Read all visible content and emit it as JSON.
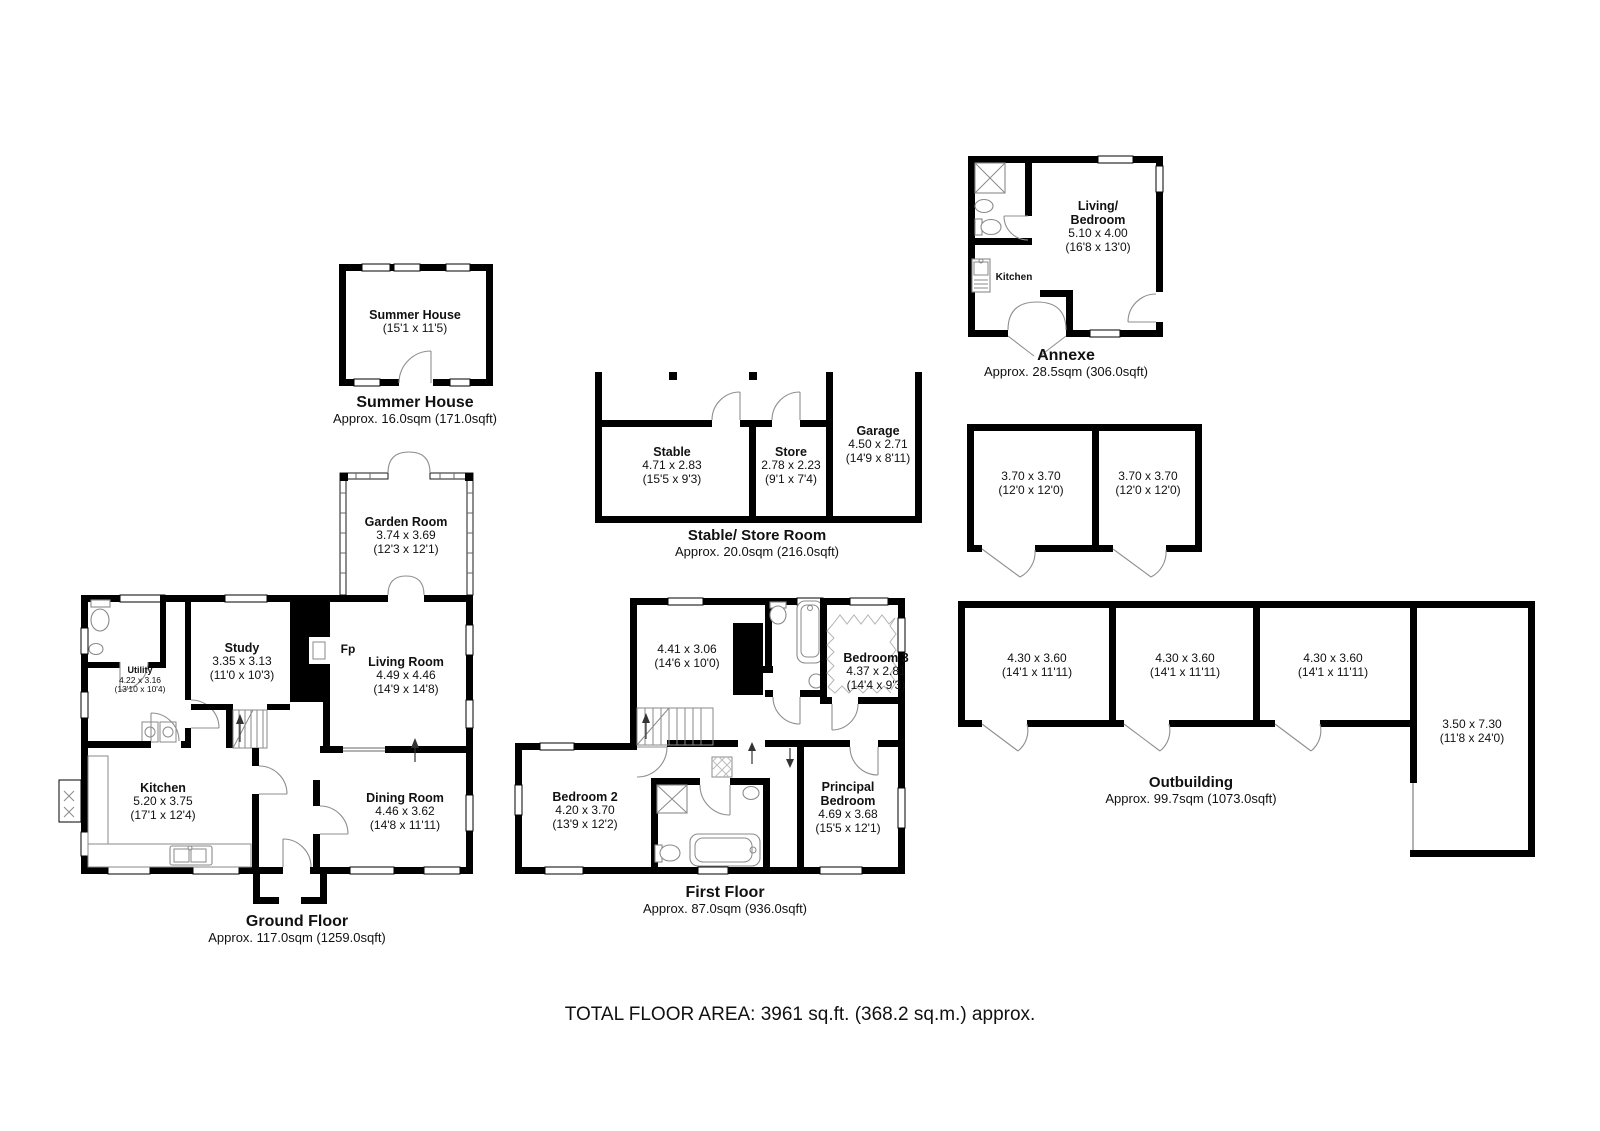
{
  "total_line": "TOTAL FLOOR AREA: 3961 sq.ft. (368.2 sq.m.) approx.",
  "summer_house": {
    "room": {
      "name": "Summer House",
      "ft": "(15'1 x 11'5)"
    },
    "title": "Summer House",
    "area": "Approx. 16.0sqm (171.0sqft)"
  },
  "garden_room": {
    "name": "Garden Room",
    "m": "3.74 x 3.69",
    "ft": "(12'3 x 12'1)"
  },
  "ground_floor": {
    "title": "Ground Floor",
    "area": "Approx. 117.0sqm (1259.0sqft)",
    "utility": {
      "name": "Utility",
      "m": "4.22 x 3.16",
      "ft": "(13'10 x 10'4)"
    },
    "study": {
      "name": "Study",
      "m": "3.35 x 3.13",
      "ft": "(11'0 x 10'3)"
    },
    "living": {
      "name": "Living Room",
      "m": "4.49 x 4.46",
      "ft": "(14'9 x 14'8)"
    },
    "kitchen": {
      "name": "Kitchen",
      "m": "5.20 x 3.75",
      "ft": "(17'1 x 12'4)"
    },
    "dining": {
      "name": "Dining Room",
      "m": "4.46 x 3.62",
      "ft": "(14'8 x 11'11)"
    },
    "fireplace": "Fp"
  },
  "stable_block": {
    "title": "Stable/ Store Room",
    "area": "Approx. 20.0sqm (216.0sqft)",
    "stable": {
      "name": "Stable",
      "m": "4.71 x 2.83",
      "ft": "(15'5 x 9'3)"
    },
    "store": {
      "name": "Store",
      "m": "2.78 x 2.23",
      "ft": "(9'1 x 7'4)"
    },
    "garage": {
      "name": "Garage",
      "m": "4.50 x 2.71",
      "ft": "(14'9 x 8'11)"
    }
  },
  "annexe": {
    "title": "Annexe",
    "area": "Approx. 28.5sqm (306.0sqft)",
    "living": {
      "name1": "Living/",
      "name2": "Bedroom",
      "m": "5.10 x 4.00",
      "ft": "(16'8 x 13'0)"
    },
    "kitchen_label": "Kitchen"
  },
  "garden_stores": {
    "room1": {
      "m": "3.70 x 3.70",
      "ft": "(12'0 x 12'0)"
    },
    "room2": {
      "m": "3.70 x 3.70",
      "ft": "(12'0 x 12'0)"
    }
  },
  "first_floor": {
    "title": "First Floor",
    "area": "Approx. 87.0sqm (936.0sqft)",
    "landing": {
      "m": "4.41 x 3.06",
      "ft": "(14'6 x 10'0)"
    },
    "bedroom3": {
      "name": "Bedroom 3",
      "m": "4.37 x 2.81",
      "ft": "(14'4 x 9'3)"
    },
    "bedroom2": {
      "name": "Bedroom 2",
      "m": "4.20 x 3.70",
      "ft": "(13'9 x 12'2)"
    },
    "principal": {
      "name1": "Principal",
      "name2": "Bedroom",
      "m": "4.69 x 3.68",
      "ft": "(15'5 x 12'1)"
    }
  },
  "outbuilding": {
    "title": "Outbuilding",
    "area": "Approx. 99.7sqm (1073.0sqft)",
    "room1": {
      "m": "4.30 x 3.60",
      "ft": "(14'1 x 11'11)"
    },
    "room2": {
      "m": "4.30 x 3.60",
      "ft": "(14'1 x 11'11)"
    },
    "room3": {
      "m": "4.30 x 3.60",
      "ft": "(14'1 x 11'11)"
    },
    "store_tall": {
      "m": "3.50 x 7.30",
      "ft": "(11'8 x 24'0)"
    }
  }
}
